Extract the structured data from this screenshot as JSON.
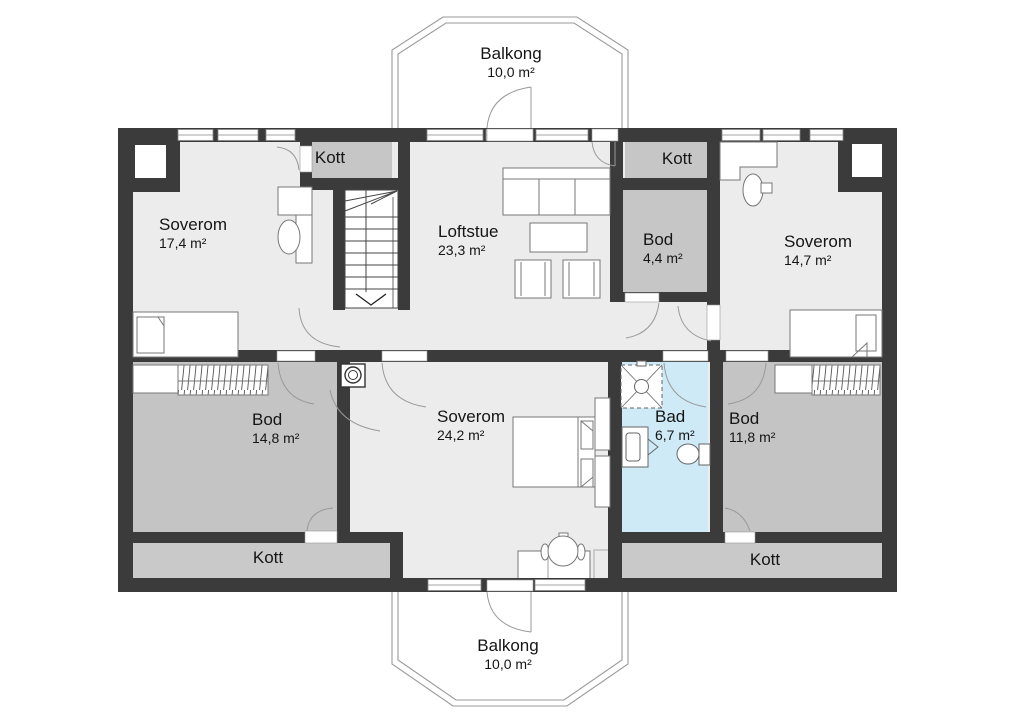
{
  "plan_title": "Floor plan",
  "colors": {
    "wall": "#3b3b3b",
    "floor_light": "#ececec",
    "floor_storage": "#c6c6c6",
    "floor_bath": "#cdeaf6",
    "outline": "#888888"
  },
  "rooms": [
    {
      "id": "balkong-top",
      "name": "Balkong",
      "area": "10,0 m²"
    },
    {
      "id": "kott-top-left",
      "name": "Kott"
    },
    {
      "id": "soverom-nw",
      "name": "Soverom",
      "area": "17,4 m²"
    },
    {
      "id": "loftstue",
      "name": "Loftstue",
      "area": "23,3 m²"
    },
    {
      "id": "kott-top-right",
      "name": "Kott"
    },
    {
      "id": "bod-small",
      "name": "Bod",
      "area": "4,4 m²"
    },
    {
      "id": "soverom-ne",
      "name": "Soverom",
      "area": "14,7 m²"
    },
    {
      "id": "bod-sw",
      "name": "Bod",
      "area": "14,8 m²"
    },
    {
      "id": "soverom-s",
      "name": "Soverom",
      "area": "24,2 m²"
    },
    {
      "id": "bad",
      "name": "Bad",
      "area": "6,7 m²"
    },
    {
      "id": "bod-se",
      "name": "Bod",
      "area": "11,8 m²"
    },
    {
      "id": "kott-bottom-left",
      "name": "Kott"
    },
    {
      "id": "kott-bottom-right",
      "name": "Kott"
    },
    {
      "id": "balkong-bottom",
      "name": "Balkong",
      "area": "10,0 m²"
    }
  ]
}
